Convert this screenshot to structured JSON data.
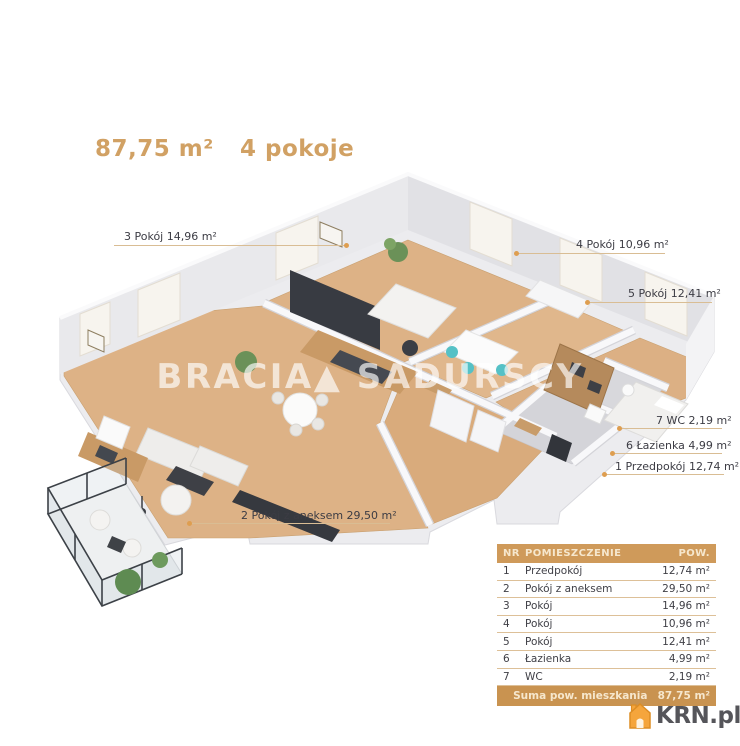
{
  "header": {
    "area_label": "87,75 m²",
    "rooms_label": "4 pokoje"
  },
  "watermark": {
    "text": "BRACIA▲ SADURSCY"
  },
  "plan_labels": [
    {
      "id": "room-3",
      "text": "3 Pokój 14,96 m²"
    },
    {
      "id": "room-4",
      "text": "4 Pokój 10,96 m²"
    },
    {
      "id": "room-5",
      "text": "5 Pokój 12,41 m²"
    },
    {
      "id": "wc-7",
      "text": "7 WC 2,19 m²"
    },
    {
      "id": "bathroom-6",
      "text": "6 Łazienka 4,99 m²"
    },
    {
      "id": "hall-1",
      "text": "1 Przedpokój 12,74 m²"
    },
    {
      "id": "room-2",
      "text": "2 Pokój z aneksem 29,50 m²"
    }
  ],
  "table": {
    "header": {
      "nr": "NR",
      "name": "POMIESZCZENIE",
      "area": "POW."
    },
    "rows": [
      {
        "nr": "1",
        "name": "Przedpokój",
        "area": "12,74 m²"
      },
      {
        "nr": "2",
        "name": "Pokój z aneksem",
        "area": "29,50 m²"
      },
      {
        "nr": "3",
        "name": "Pokój",
        "area": "14,96 m²"
      },
      {
        "nr": "4",
        "name": "Pokój",
        "area": "10,96 m²"
      },
      {
        "nr": "5",
        "name": "Pokój",
        "area": "12,41 m²"
      },
      {
        "nr": "6",
        "name": "Łazienka",
        "area": "4,99 m²"
      },
      {
        "nr": "7",
        "name": "WC",
        "area": "2,19 m²"
      }
    ],
    "footer": {
      "label": "Suma pow. mieszkania",
      "value": "87,75 m²"
    }
  },
  "logo": {
    "text": "KRN.pl"
  },
  "colors": {
    "accent_gold": "#d1a164",
    "table_header_bg": "#cf9a5a",
    "table_footer_bg": "#c99350",
    "leader_line": "#d9bd94",
    "leader_dot": "#de9e50",
    "wood_floor": "#dcb084",
    "tile_floor": "#d8d8dc",
    "wall_face": "#e1e1e5",
    "dark_furniture": "#383b42",
    "logo_orange": "#f5a53c"
  }
}
